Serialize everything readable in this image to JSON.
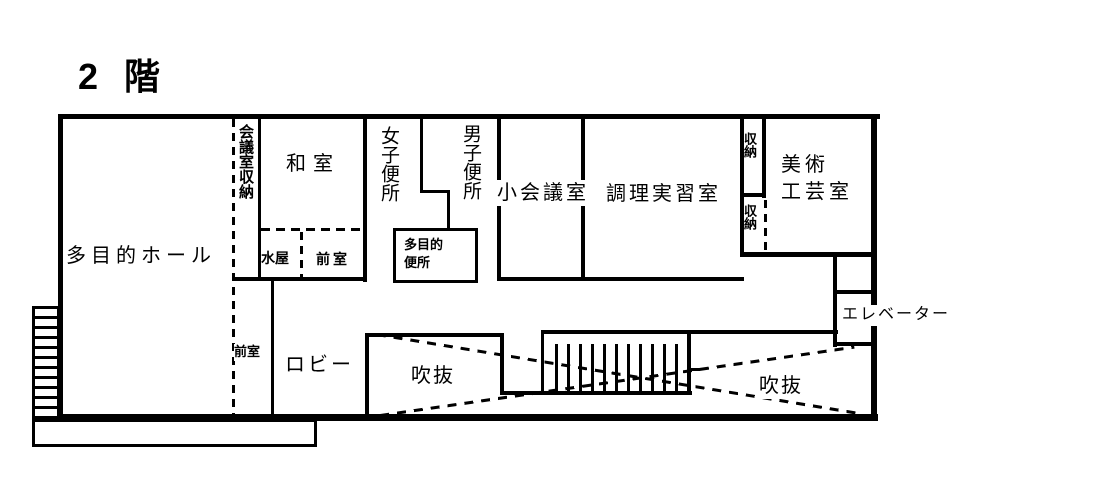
{
  "title": "2 階",
  "rooms": {
    "multipurpose_hall": "多目的ホール",
    "meeting_room_storage": "会議室収納",
    "japanese_room": "和室",
    "mizuya": "水屋",
    "anteroom_top": "前室",
    "womens_toilet": "女子便所",
    "mens_toilet": "男子便所",
    "multipurpose_toilet": "多目的\n便所",
    "small_meeting_room": "小会議室",
    "cooking_practice_room": "調理実習室",
    "storage_upper": "収納",
    "storage_lower": "収納",
    "art_craft_room": "美術\n工芸室",
    "elevator": "エレベーター",
    "anteroom_bottom": "前室",
    "lobby": "ロビー",
    "void_left": "吹抜",
    "void_right": "吹抜"
  },
  "colors": {
    "line": "#000000",
    "background": "#ffffff"
  }
}
